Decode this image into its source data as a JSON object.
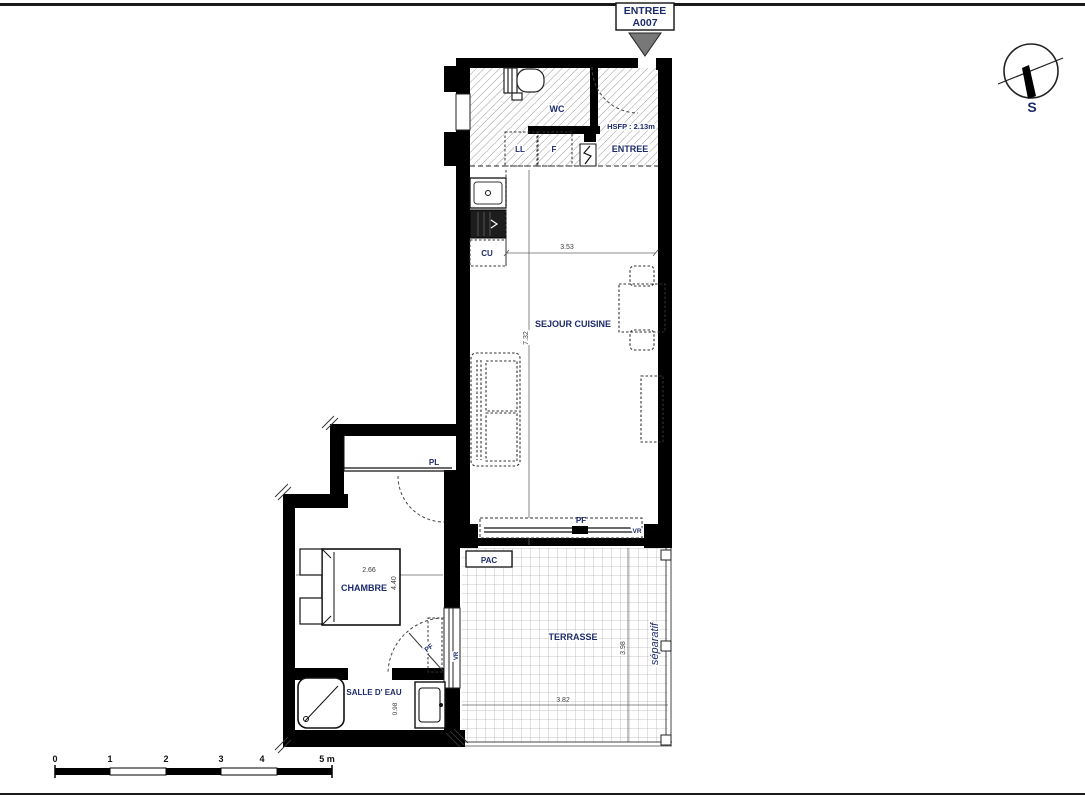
{
  "colors": {
    "label": "#1c2a6b",
    "dimension": "#3c3c3c",
    "wall": "#000000",
    "entry_arrow_fill": "#787878",
    "terrace_grid": "#b5b5b5"
  },
  "entry_marker": {
    "line1": "ENTREE",
    "line2": "A007"
  },
  "north_indicator": {
    "label": "S"
  },
  "rooms": {
    "wc": "WC",
    "entree": "ENTREE",
    "sejour": "SEJOUR CUISINE",
    "chambre": "CHAMBRE",
    "salle_deau": "SALLE D' EAU",
    "terrasse": "TERRASSE"
  },
  "annotations": {
    "hsfp": "HSFP : 2.13m",
    "ll": "LL",
    "f": "F",
    "cu": "CU",
    "pl": "PL",
    "pac": "PAC",
    "pf_sejour": "PF",
    "vr_sejour": "VR",
    "pf_chambre": "PF",
    "vr_chambre": "VR",
    "separatif": "séparatif"
  },
  "dimensions": {
    "sejour_width": "3.53",
    "sejour_length": "7.32",
    "chambre_width": "2.66",
    "chambre_length": "4.40",
    "salle_deau_depth": "0.98",
    "terrasse_length": "3.98",
    "terrasse_width": "3.82"
  },
  "scale_bar": {
    "labels": [
      "0",
      "1",
      "2",
      "3",
      "4",
      "5 m"
    ]
  }
}
